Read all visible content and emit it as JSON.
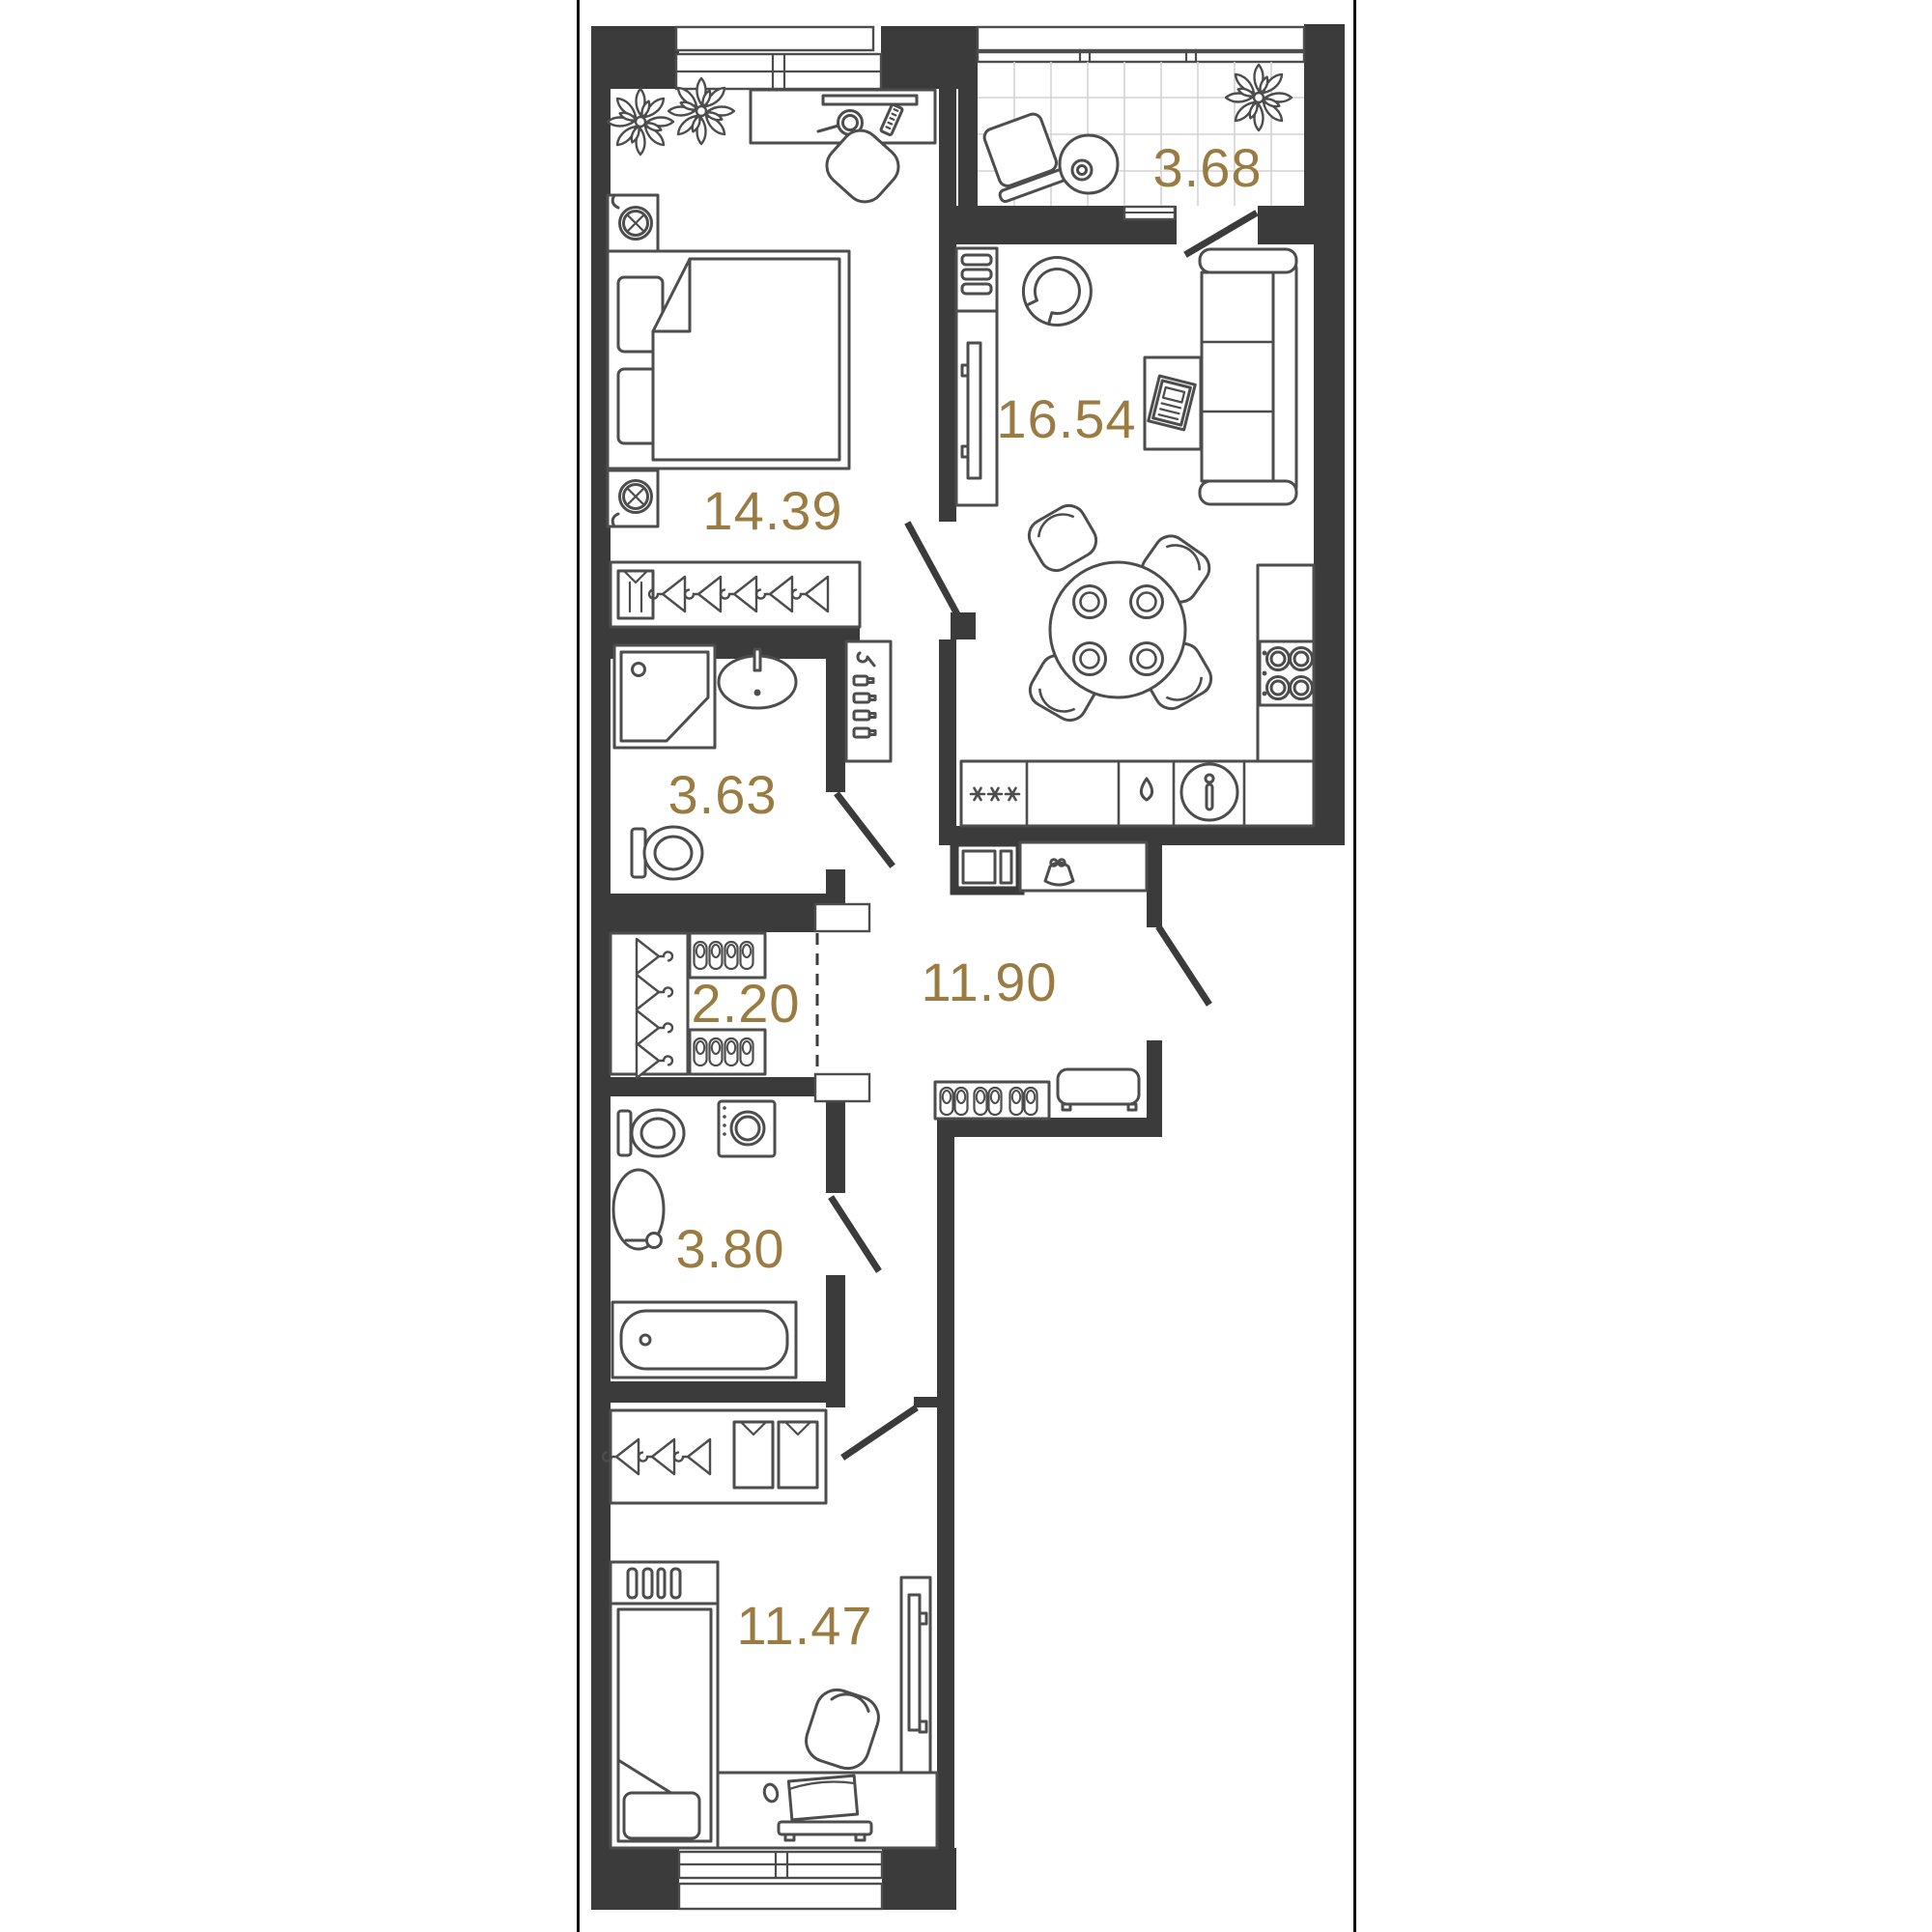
{
  "page": {
    "background": "#ffffff",
    "frame_color": "#000000"
  },
  "palette": {
    "wall": "#3b3b3b",
    "furniture_line": "#4d4d4d",
    "label": "#9a7b41",
    "tile_line": "#d4d4d4"
  },
  "rooms": [
    {
      "id": "living-kitchen",
      "area": "16.54",
      "furniture": [
        "tv-shelf",
        "tv-console",
        "armchair",
        "sofa",
        "coffee-table",
        "magazine",
        "dining-table",
        "dining-chairs",
        "hob",
        "kitchen-counter",
        "fridge",
        "kitchen-sink",
        "drop-icon"
      ]
    },
    {
      "id": "bedroom-1",
      "area": "14.39",
      "furniture": [
        "double-bed",
        "pillows",
        "blanket",
        "nightstand-lamp-top",
        "nightstand-lamp-bottom",
        "desk",
        "mirror",
        "comb",
        "chair",
        "plant",
        "plant",
        "wardrobe-hangers",
        "folded-shirt"
      ]
    },
    {
      "id": "hallway",
      "area": "11.90",
      "furniture": [
        "electric-panel",
        "console-shelf",
        "purse-icon",
        "shoe-rack",
        "bench",
        "cosmetic-shelf",
        "bottles",
        "hook"
      ]
    },
    {
      "id": "bedroom-2",
      "area": "11.47",
      "furniture": [
        "single-bed",
        "headboard-shelf",
        "pillow",
        "desk",
        "laptop",
        "keyboard",
        "mouse",
        "chair",
        "tv-console",
        "wardrobe-hangers",
        "folded-shirts"
      ]
    },
    {
      "id": "loggia",
      "area": "3.68",
      "furniture": [
        "chair",
        "round-table",
        "plant",
        "floor-tiles"
      ]
    },
    {
      "id": "bathroom-1",
      "area": "3.63",
      "furniture": [
        "shower-cabin",
        "washbasin",
        "toilet"
      ]
    },
    {
      "id": "bathroom-2",
      "area": "3.80",
      "furniture": [
        "toilet",
        "washing-machine",
        "washbasin",
        "bathtub"
      ]
    },
    {
      "id": "wardrobe",
      "area": "2.20",
      "furniture": [
        "hanger-rod",
        "shoe-shelf-top",
        "shoe-shelf-bottom"
      ]
    }
  ]
}
